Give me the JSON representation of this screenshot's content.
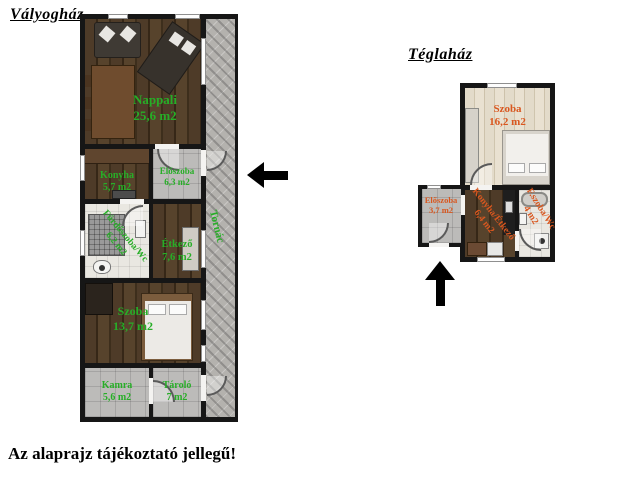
{
  "page": {
    "disclaimer": "Az alaprajz tájékoztató jellegű!"
  },
  "colors": {
    "wall": "#161616",
    "label_green": "#27ae27",
    "label_orange": "#d9571f"
  },
  "icons": {
    "west_arrow": "arrow-left",
    "north_arrow": "arrow-up"
  },
  "plans": {
    "valyoghaz": {
      "title": "Vályogház",
      "rooms": {
        "nappali": {
          "name": "Nappali",
          "area": "25,6 m2"
        },
        "konyha": {
          "name": "Konyha",
          "area": "5,7 m2"
        },
        "eloszoba": {
          "name": "Előszoba",
          "area": "6,3 m2"
        },
        "furdoszoba": {
          "name": "Fürdőszoba/Wc",
          "area": "6,2 m2"
        },
        "etkezo": {
          "name": "Étkező",
          "area": "7,6 m2"
        },
        "szoba": {
          "name": "Szoba",
          "area": "13,7 m2"
        },
        "kamra": {
          "name": "Kamra",
          "area": "5,6 m2"
        },
        "tarolo": {
          "name": "Tároló",
          "area": "7 m2"
        },
        "tornac": {
          "name": "Tornác",
          "area": ""
        }
      }
    },
    "teglahaz": {
      "title": "Téglaház",
      "rooms": {
        "szoba": {
          "name": "Szoba",
          "area": "16,2 m2"
        },
        "eloszoba": {
          "name": "Előszoba",
          "area": "3,7 m2"
        },
        "konyha_etkezo": {
          "name": "Konyha/Étkező",
          "area": "6,4 m2"
        },
        "fszoba": {
          "name": "F.szoba/Wc",
          "area": "4 m2"
        }
      }
    }
  }
}
